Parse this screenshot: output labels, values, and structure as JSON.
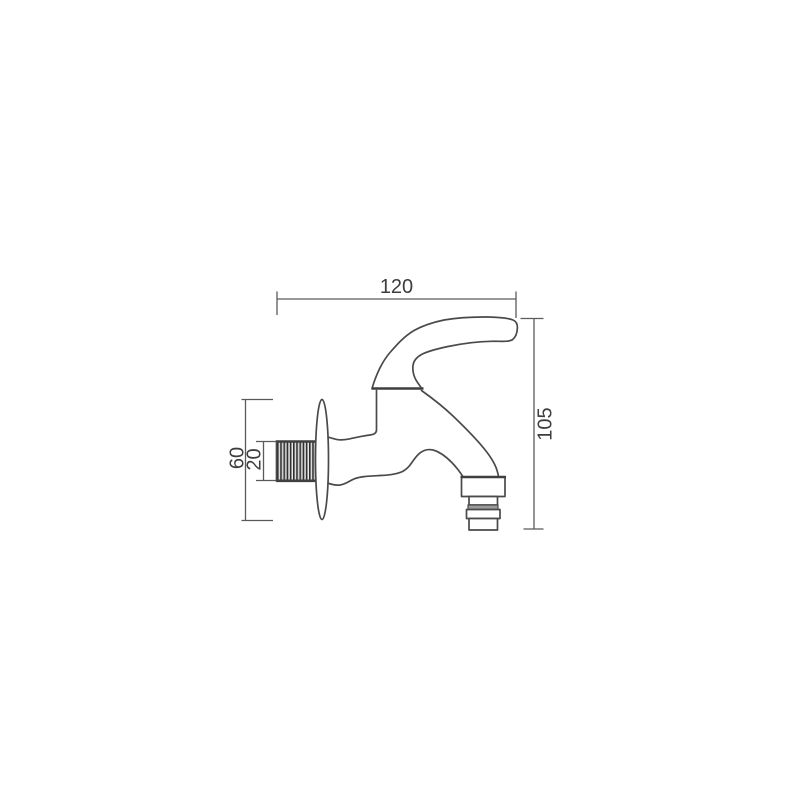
{
  "page": {
    "background": "#ffffff"
  },
  "drawing": {
    "type": "technical-dimension-drawing",
    "subject": "wall-mounted bib tap (faucet), side view",
    "line_color": "#4a4a4a",
    "thread_fill_color": "#bcbcbc",
    "dimensions": {
      "overall_length": "120",
      "overall_height": "105",
      "flange_diameter": "60",
      "thread_diameter": "20"
    }
  }
}
